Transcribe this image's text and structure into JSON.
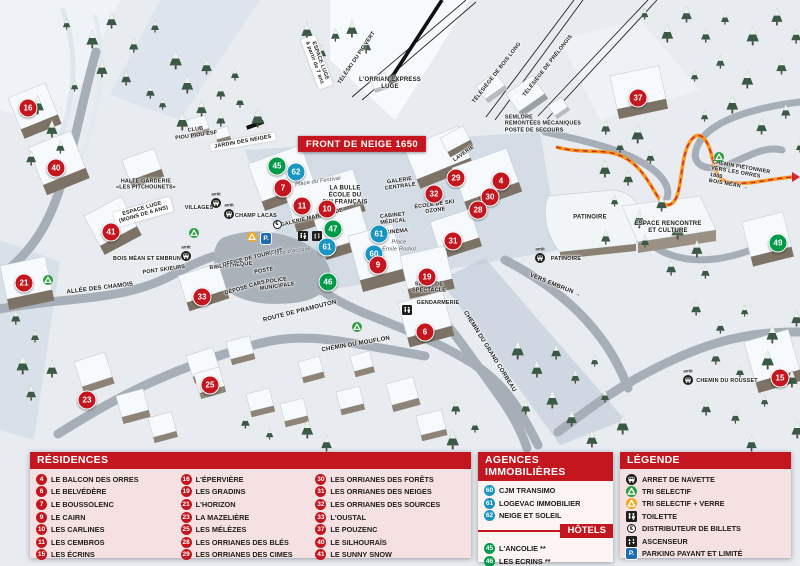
{
  "map": {
    "banner": "FRONT DE NEIGE 1650",
    "arret_word": "arrêt",
    "icon_glyphs": {
      "parking": "P.",
      "euro": "€"
    },
    "markers": [
      {
        "n": "16",
        "x": 28,
        "y": 108,
        "c": "red"
      },
      {
        "n": "40",
        "x": 56,
        "y": 168,
        "c": "red"
      },
      {
        "n": "41",
        "x": 111,
        "y": 232,
        "c": "red"
      },
      {
        "n": "21",
        "x": 24,
        "y": 283,
        "c": "red"
      },
      {
        "n": "33",
        "x": 202,
        "y": 297,
        "c": "red"
      },
      {
        "n": "23",
        "x": 87,
        "y": 400,
        "c": "red"
      },
      {
        "n": "25",
        "x": 210,
        "y": 385,
        "c": "red"
      },
      {
        "n": "45",
        "x": 277,
        "y": 166,
        "c": "green"
      },
      {
        "n": "62",
        "x": 296,
        "y": 172,
        "c": "blue"
      },
      {
        "n": "7",
        "x": 283,
        "y": 188,
        "c": "red"
      },
      {
        "n": "11",
        "x": 302,
        "y": 206,
        "c": "red"
      },
      {
        "n": "10",
        "x": 327,
        "y": 209,
        "c": "red"
      },
      {
        "n": "47",
        "x": 333,
        "y": 229,
        "c": "green"
      },
      {
        "n": "61",
        "x": 327,
        "y": 247,
        "c": "blue"
      },
      {
        "n": "61",
        "x": 379,
        "y": 234,
        "c": "blue"
      },
      {
        "n": "60",
        "x": 374,
        "y": 254,
        "c": "blue"
      },
      {
        "n": "9",
        "x": 378,
        "y": 265,
        "c": "red"
      },
      {
        "n": "46",
        "x": 328,
        "y": 282,
        "c": "green"
      },
      {
        "n": "32",
        "x": 434,
        "y": 194,
        "c": "red"
      },
      {
        "n": "29",
        "x": 456,
        "y": 178,
        "c": "red"
      },
      {
        "n": "4",
        "x": 501,
        "y": 181,
        "c": "red"
      },
      {
        "n": "30",
        "x": 490,
        "y": 197,
        "c": "red"
      },
      {
        "n": "28",
        "x": 478,
        "y": 210,
        "c": "red"
      },
      {
        "n": "31",
        "x": 453,
        "y": 241,
        "c": "red"
      },
      {
        "n": "19",
        "x": 427,
        "y": 277,
        "c": "red"
      },
      {
        "n": "6",
        "x": 425,
        "y": 332,
        "c": "red"
      },
      {
        "n": "37",
        "x": 638,
        "y": 98,
        "c": "red"
      },
      {
        "n": "49",
        "x": 778,
        "y": 243,
        "c": "green"
      },
      {
        "n": "15",
        "x": 780,
        "y": 378,
        "c": "red"
      }
    ],
    "labels": [
      {
        "id": "lorrian-express-luge",
        "text": "L'ORRIAN EXPRESS\nLUGE",
        "x": 390,
        "y": 84,
        "rot": 0,
        "cls": ""
      },
      {
        "id": "teleski-pic-vert",
        "text": "TÉLÉSKI DU PIC VERT",
        "x": 357,
        "y": 58,
        "rot": -56,
        "cls": "sm"
      },
      {
        "id": "telesiege-bois-long",
        "text": "TÉLÉSIÈGE DE BOIS LONG",
        "x": 497,
        "y": 73,
        "rot": -52,
        "cls": "sm"
      },
      {
        "id": "telesiege-prelongis",
        "text": "TÉLÉSIÈGE DE PRÉLONGIS",
        "x": 548,
        "y": 66,
        "rot": -52,
        "cls": "sm"
      },
      {
        "id": "semlore",
        "text": "SEMLORE\nREMONTÉES MÉCANIQUES\nPOSTE DE SECOURS",
        "x": 543,
        "y": 124,
        "rot": 0,
        "cls": "sm left"
      },
      {
        "id": "espace-luge-7ans",
        "text": "ESPACE LUGE\nà partir de 7 ans",
        "x": 317,
        "y": 62,
        "rot": 70,
        "cls": "ribbon sm"
      },
      {
        "id": "club-piou-piou-esf",
        "text": "CLUB\nPIOU PIOU ESF",
        "x": 196,
        "y": 133,
        "rot": -8,
        "cls": "sm"
      },
      {
        "id": "jardin-des-neiges",
        "text": "JARDIN DES NEIGES",
        "x": 243,
        "y": 142,
        "rot": -10,
        "cls": "ribbon sm"
      },
      {
        "id": "halte-garderie",
        "text": "HALTE GARDERIE\n«LES PITCHOUNETS»",
        "x": 146,
        "y": 185,
        "rot": 0,
        "cls": "sm"
      },
      {
        "id": "espace-luge-6ans",
        "text": "ESPACE LUGE\n(MOINS DE 6 ANS)",
        "x": 143,
        "y": 212,
        "rot": -16,
        "cls": "ribbon sm"
      },
      {
        "id": "allee-des-chamois",
        "text": "ALLÉE DES CHAMOIS",
        "x": 100,
        "y": 289,
        "rot": -7,
        "cls": ""
      },
      {
        "id": "pont-skieurs",
        "text": "PONT SKIEURS",
        "x": 164,
        "y": 270,
        "rot": -8,
        "cls": "sm"
      },
      {
        "id": "bibliotheque",
        "text": "BIBLIOTHÈQUE",
        "x": 231,
        "y": 266,
        "rot": -6,
        "cls": "sm"
      },
      {
        "id": "office-de-tourisme",
        "text": "OFFICE DE TOURISME",
        "x": 253,
        "y": 258,
        "rot": -14,
        "cls": "sm"
      },
      {
        "id": "poste",
        "text": "POSTE",
        "x": 264,
        "y": 271,
        "rot": -10,
        "cls": "sm"
      },
      {
        "id": "police-municipale",
        "text": "POLICE\nMUNICIPALE",
        "x": 277,
        "y": 284,
        "rot": -8,
        "cls": "sm"
      },
      {
        "id": "depose-cars",
        "text": "DÉPOSE CARS",
        "x": 245,
        "y": 288,
        "rot": -16,
        "cls": "sm"
      },
      {
        "id": "place-accueil",
        "text": "Place d'accueil",
        "x": 291,
        "y": 252,
        "rot": -8,
        "cls": "it"
      },
      {
        "id": "place-du-festival",
        "text": "Place du Festival",
        "x": 318,
        "y": 182,
        "rot": -8,
        "cls": "it"
      },
      {
        "id": "la-bulle-ecole-ski-francais",
        "text": "LA BULLE\nÉCOLE DU\nSKI FRANÇAIS",
        "x": 345,
        "y": 196,
        "rot": 0,
        "cls": ""
      },
      {
        "id": "galerie-marchande",
        "text": "GALERIE MARCHANDE",
        "x": 312,
        "y": 218,
        "rot": -14,
        "cls": "sm"
      },
      {
        "id": "galerie-centrale",
        "text": "GALERIE\nCENTRALE",
        "x": 400,
        "y": 184,
        "rot": -8,
        "cls": "sm"
      },
      {
        "id": "laverie",
        "text": "LAVERIE",
        "x": 464,
        "y": 154,
        "rot": -35,
        "cls": "sm"
      },
      {
        "id": "ecole-de-ski-ozone",
        "text": "ÉCOLE DE SKI\nOZONE",
        "x": 435,
        "y": 208,
        "rot": -8,
        "cls": "sm"
      },
      {
        "id": "cabinet-medical",
        "text": "CABINET\nMÉDICAL",
        "x": 393,
        "y": 219,
        "rot": -6,
        "cls": "sm"
      },
      {
        "id": "cinema",
        "text": "CINÉMA",
        "x": 397,
        "y": 232,
        "rot": -6,
        "cls": "sm"
      },
      {
        "id": "place-emile-rodiol",
        "text": "Place\nÉmile Rodiol",
        "x": 399,
        "y": 246,
        "rot": 0,
        "cls": "it"
      },
      {
        "id": "salle-de-spectacle",
        "text": "SALLE DE\nSPECTACLE",
        "x": 429,
        "y": 288,
        "rot": 0,
        "cls": "sm"
      },
      {
        "id": "gendarmerie",
        "text": "GENDARMERIE",
        "x": 438,
        "y": 303,
        "rot": 0,
        "cls": "sm"
      },
      {
        "id": "route-de-pramouton",
        "text": "ROUTE DE PRAMOUTON",
        "x": 300,
        "y": 312,
        "rot": -14,
        "cls": ""
      },
      {
        "id": "chemin-du-mouflon",
        "text": "CHEMIN DU MOUFLON",
        "x": 356,
        "y": 345,
        "rot": -10,
        "cls": ""
      },
      {
        "id": "chemin-du-grand-corbeau",
        "text": "CHEMIN DU GRAND CORBEAU",
        "x": 489,
        "y": 352,
        "rot": 58,
        "cls": ""
      },
      {
        "id": "vers-embrun",
        "text": "VERS EMBRUN →",
        "x": 555,
        "y": 286,
        "rot": 22,
        "cls": ""
      },
      {
        "id": "patinoire-batiment",
        "text": "PATINOIRE",
        "x": 590,
        "y": 218,
        "rot": 0,
        "cls": ""
      },
      {
        "id": "espace-rencontre-et-culture",
        "text": "ESPACE RENCONTRE\nET CULTURE",
        "x": 668,
        "y": 228,
        "rot": 0,
        "cls": ""
      },
      {
        "id": "chemin-pietonnier-1800",
        "text": "CHEMIN PIÉTONNIER\nVERS LES ORRES 1800\nBOIS MÉAN →",
        "x": 740,
        "y": 177,
        "rot": 10,
        "cls": "sm left"
      }
    ],
    "bus_stops": [
      {
        "label": "VILLAGES",
        "x": 199,
        "y": 208,
        "ix": 216,
        "iy": 203
      },
      {
        "label": "CHAMP LACAS",
        "x": 256,
        "y": 216,
        "ix": 229,
        "iy": 214
      },
      {
        "label": "BOIS MÉAN ET EMBRUN",
        "x": 147,
        "y": 259,
        "ix": 186,
        "iy": 256
      },
      {
        "label": "PATINOIRE",
        "x": 566,
        "y": 259,
        "ix": 540,
        "iy": 258
      },
      {
        "label": "CHEMIN DU ROUSSET",
        "x": 727,
        "y": 381,
        "ix": 688,
        "iy": 380
      }
    ],
    "icons": [
      {
        "t": "parking",
        "x": 266,
        "y": 238
      },
      {
        "t": "euro",
        "x": 277,
        "y": 224
      },
      {
        "t": "recycle-yellow",
        "x": 252,
        "y": 237
      },
      {
        "t": "recycle-green",
        "x": 48,
        "y": 280
      },
      {
        "t": "recycle-green",
        "x": 194,
        "y": 233
      },
      {
        "t": "recycle-green",
        "x": 719,
        "y": 157
      },
      {
        "t": "recycle-green",
        "x": 357,
        "y": 327
      },
      {
        "t": "toilet",
        "x": 303,
        "y": 236
      },
      {
        "t": "elevator",
        "x": 317,
        "y": 236
      },
      {
        "t": "toilet",
        "x": 407,
        "y": 310
      }
    ]
  },
  "panels": {
    "residences": {
      "title": "RÉSIDENCES",
      "items": [
        {
          "n": "4",
          "label": "LE BALCON DES ORRES"
        },
        {
          "n": "6",
          "label": "LE BELVÉDÈRE"
        },
        {
          "n": "7",
          "label": "LE BOUSSOLENC"
        },
        {
          "n": "9",
          "label": "LE CAIRN"
        },
        {
          "n": "10",
          "label": "LES CARLINES"
        },
        {
          "n": "11",
          "label": "LES CEMBROS"
        },
        {
          "n": "15",
          "label": "LES ÉCRINS"
        },
        {
          "n": "16",
          "label": "L'ÉPERVIÈRE"
        },
        {
          "n": "19",
          "label": "LES GRADINS"
        },
        {
          "n": "21",
          "label": "L'HORIZON"
        },
        {
          "n": "23",
          "label": "LA MAZELIÈRE"
        },
        {
          "n": "25",
          "label": "LES MÉLÈZES"
        },
        {
          "n": "28",
          "label": "LES ORRIANES DES BLÉS"
        },
        {
          "n": "29",
          "label": "LES ORRIANES DES CIMES"
        },
        {
          "n": "30",
          "label": "LES ORRIANES DES FORÊTS"
        },
        {
          "n": "31",
          "label": "LES ORRIANES DES NEIGES"
        },
        {
          "n": "32",
          "label": "LES ORRIANES DES SOURCES"
        },
        {
          "n": "33",
          "label": "L'OUSTAL"
        },
        {
          "n": "37",
          "label": "LE POUZENC"
        },
        {
          "n": "40",
          "label": "LE SILHOURAÏS"
        },
        {
          "n": "41",
          "label": "LE SUNNY SNOW"
        }
      ]
    },
    "agences": {
      "title": "AGENCES IMMOBILIÈRES",
      "items": [
        {
          "n": "60",
          "label": "CJM TRANSIMO"
        },
        {
          "n": "61",
          "label": "LOGEVAC IMMOBILIER"
        },
        {
          "n": "62",
          "label": "NEIGE ET SOLEIL"
        }
      ]
    },
    "hotels": {
      "title": "HÔTELS",
      "items": [
        {
          "n": "45",
          "label": "L'ANCOLIE **"
        },
        {
          "n": "46",
          "label": "LES ECRINS **"
        },
        {
          "n": "47",
          "label": "L'ESCALE BLANCHE ***"
        },
        {
          "n": "49",
          "label": "LES TRAPPEURS **"
        }
      ]
    },
    "legende": {
      "title": "LÉGENDE",
      "items": [
        {
          "icon": "bus",
          "label": "ARRET DE NAVETTE"
        },
        {
          "icon": "recycle-green",
          "label": "TRI SELECTIF"
        },
        {
          "icon": "recycle-yellow",
          "label": "TRI SELECTIF + VERRE"
        },
        {
          "icon": "toilet",
          "label": "TOILETTE"
        },
        {
          "icon": "euro",
          "label": "DISTRIBUTEUR DE BILLETS"
        },
        {
          "icon": "elevator",
          "label": "ASCENSEUR"
        },
        {
          "icon": "parking",
          "label": "PARKING PAYANT ET LIMITÉ"
        }
      ]
    }
  },
  "colors": {
    "accent_red": "#c4161f",
    "marker_blue": "#1895c0",
    "marker_green": "#009a49",
    "recycle_yellow": "#f2a71c",
    "parking_blue": "#1f6cb5"
  }
}
